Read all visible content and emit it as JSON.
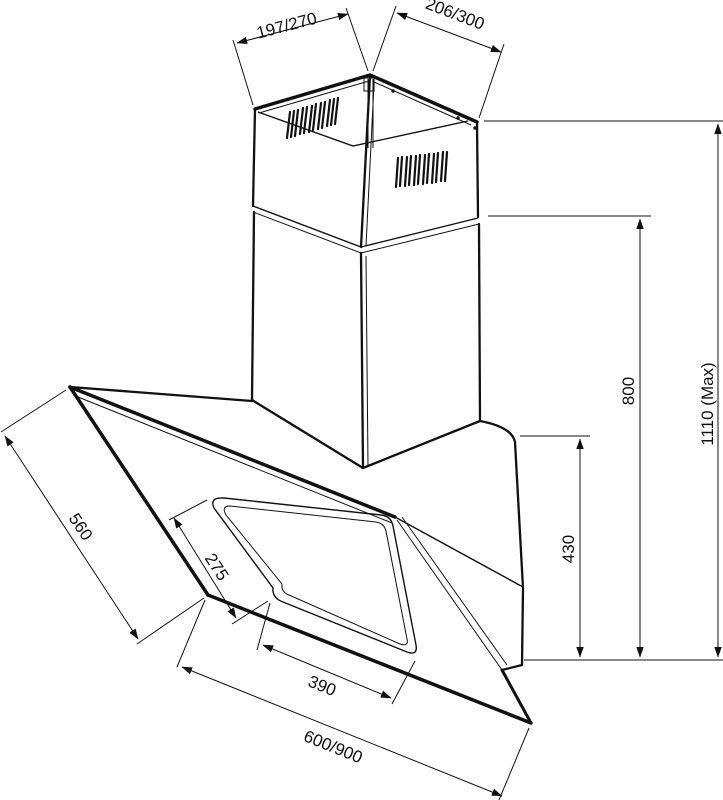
{
  "drawing": {
    "subject": "angled chimney cooker hood installation dimensions",
    "units_note": "",
    "colors": {
      "line": "#111111",
      "background": "#ffffff"
    }
  },
  "dimensions": {
    "chimney_top_left_depth": "197/270",
    "chimney_top_right_width": "206/300",
    "chimney_height": "800",
    "max_total_height": "1110 (Max)",
    "body_height": "430",
    "panel_depth": "560",
    "glass_inner_depth": "275",
    "glass_inner_width": "390",
    "hood_width": "600/900"
  }
}
